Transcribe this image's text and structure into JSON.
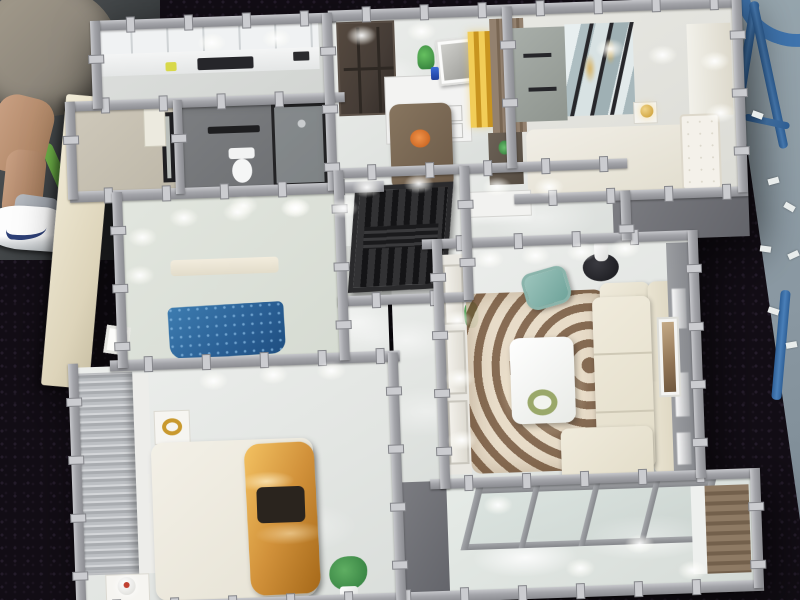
{
  "meta": {
    "description": "Photograph of a miniature architectural scale model of a furnished apartment, viewed from directly above, displayed on a black sequined table at an exhibition",
    "no_visible_text": true
  },
  "palette": {
    "cloth": "#120d15",
    "wall": "#a3a4a9",
    "goldBed": "#d1913a",
    "blueBed": "#2a5f94",
    "sofaCream": "#ece7d7",
    "rugBrown": "#76563a",
    "stoolBlue": "#3f74ae",
    "expoFloor": "#97a6ae",
    "accentGold": "#e8c23a",
    "tealChair": "#7fb3a9",
    "doorBrown": "#453c36",
    "chairGreen": "#5fa13e"
  },
  "background": {
    "table": {
      "label": "black sequined exhibition table"
    },
    "expo_floor": {
      "label": "gray exhibition hall floor with white paper scraps"
    },
    "stool": {
      "label": "blue metal stool"
    },
    "person": {
      "label": "person in gray shorts and white sneaker sitting on green chair"
    }
  },
  "rooms": [
    {
      "id": "kitchen",
      "label": "kitchen with white cabinets, counter bottles and dark cooktop"
    },
    {
      "id": "utility",
      "label": "utility room with beige walls and black framed window"
    },
    {
      "id": "bathroom",
      "label": "bathroom with toilet, black towel rack and glass shower"
    },
    {
      "id": "entry",
      "label": "entry foyer with dark brown door, sideboard, gold accent and wood cabinet"
    },
    {
      "id": "dining",
      "label": "dining area with dark wood table and four pale blue chairs"
    },
    {
      "id": "bedroom-tr",
      "label": "bedroom with mirrored wardrobe, white bed and gold lamp"
    },
    {
      "id": "den",
      "label": "den with black slatted grille partition"
    },
    {
      "id": "hallway",
      "label": "hallway with lavender flowers in white vase on black stand"
    },
    {
      "id": "bedroom-blue",
      "label": "bedroom with sparkly blue bed and wood wall shelves"
    },
    {
      "id": "master-bedroom",
      "label": "master bedroom with gold satin bed, dark pillows and flower tray"
    },
    {
      "id": "living-room",
      "label": "living room with cream L-sofa, zebra rug, coffee table with pink flowers, teal armchair and framed art"
    },
    {
      "id": "balcony",
      "label": "balcony with glass sliding doors, glossy floor and wood cabinet"
    }
  ]
}
